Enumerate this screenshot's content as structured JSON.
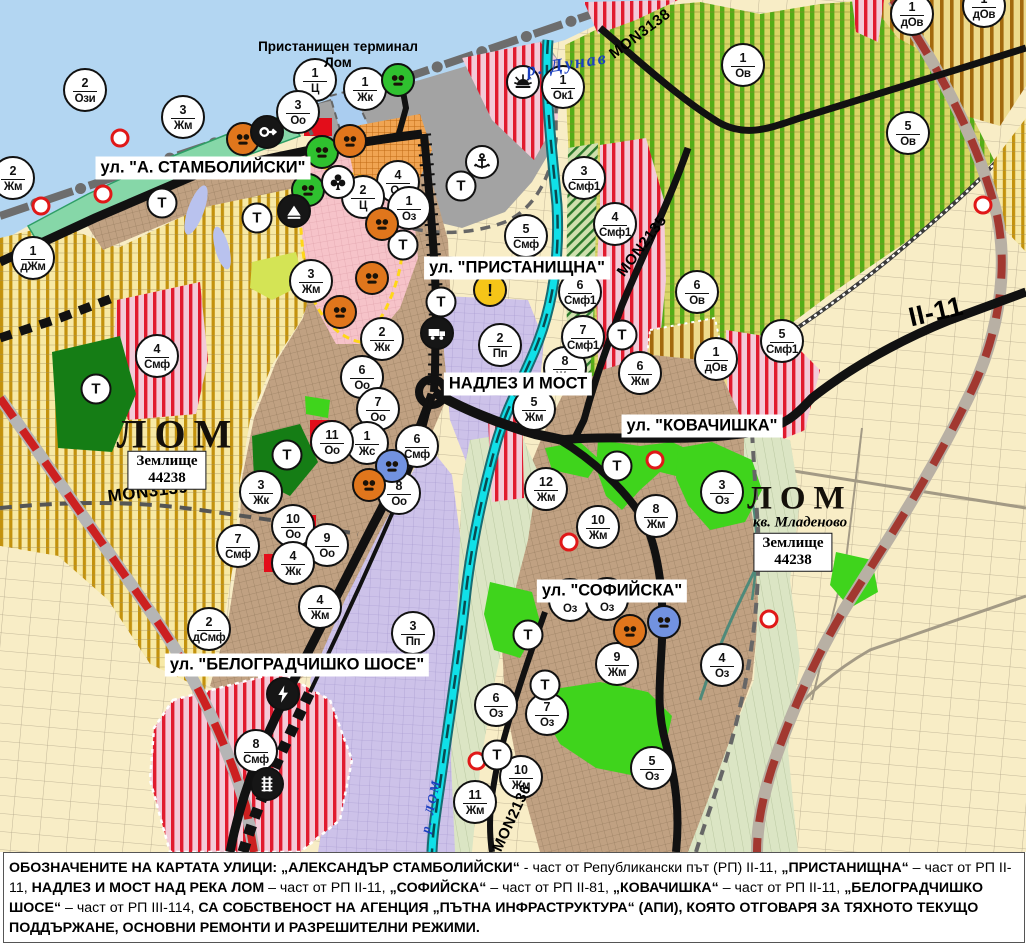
{
  "map": {
    "water_label": "р. Дунав",
    "river_label": "р. ЛОМ",
    "terminal_label": "Пристанищен терминал Лом",
    "streets": [
      {
        "text": "ул. \"А. СТАМБОЛИЙСКИ\"",
        "x": 203,
        "y": 168
      },
      {
        "text": "ул. \"ПРИСТАНИЩНА\"",
        "x": 517,
        "y": 268
      },
      {
        "text": "НАДЛЕЗ И МОСТ",
        "x": 518,
        "y": 384
      },
      {
        "text": "ул. \"КОВАЧИШКА\"",
        "x": 702,
        "y": 426
      },
      {
        "text": "ул. \"СОФИЙСКА\"",
        "x": 612,
        "y": 591
      },
      {
        "text": "ул. \"БЕЛОГРАДЧИШКО ШОСЕ\"",
        "x": 297,
        "y": 665
      }
    ],
    "road_codes": [
      {
        "text": "MON3138",
        "x": 640,
        "y": 34,
        "rot": -37,
        "size": 15
      },
      {
        "text": "MON2135",
        "x": 642,
        "y": 246,
        "rot": -53,
        "size": 15
      },
      {
        "text": "MON3139",
        "x": 148,
        "y": 492,
        "rot": -7,
        "size": 17
      },
      {
        "text": "MON2136",
        "x": 512,
        "y": 818,
        "rot": -65,
        "size": 15
      },
      {
        "text": "II-11",
        "x": 936,
        "y": 312,
        "rot": -13,
        "size": 27
      }
    ],
    "areas": [
      {
        "text": "ЛОМ",
        "x": 178,
        "y": 434,
        "size": 40
      },
      {
        "text": "ЛОМ",
        "x": 800,
        "y": 499,
        "size": 33
      }
    ],
    "district_label": "кв. Младеново",
    "land_boxes": [
      {
        "line1": "Землище",
        "line2": "44238",
        "x": 167,
        "y": 470
      },
      {
        "line1": "Землище",
        "line2": "44238",
        "x": 793,
        "y": 552
      }
    ]
  },
  "markers": {
    "t_label": "Т",
    "warn_label": "!",
    "zones": [
      {
        "x": 85,
        "y": 90,
        "n": "2",
        "c": "Ози"
      },
      {
        "x": 315,
        "y": 80,
        "n": "1",
        "c": "Ц"
      },
      {
        "x": 298,
        "y": 112,
        "n": "3",
        "c": "Оо"
      },
      {
        "x": 365,
        "y": 89,
        "n": "1",
        "c": "Жк"
      },
      {
        "x": 563,
        "y": 87,
        "n": "1",
        "c": "Ок1"
      },
      {
        "x": 183,
        "y": 117,
        "n": "3",
        "c": "Жм"
      },
      {
        "x": 13,
        "y": 178,
        "n": "2",
        "c": "Жм"
      },
      {
        "x": 33,
        "y": 258,
        "n": "1",
        "c": "дЖм"
      },
      {
        "x": 398,
        "y": 182,
        "n": "4",
        "c": "Оо"
      },
      {
        "x": 363,
        "y": 197,
        "n": "2",
        "c": "Ц"
      },
      {
        "x": 409,
        "y": 208,
        "n": "1",
        "c": "Оз"
      },
      {
        "x": 584,
        "y": 178,
        "n": "3",
        "c": "Смф1"
      },
      {
        "x": 526,
        "y": 236,
        "n": "5",
        "c": "Смф"
      },
      {
        "x": 580,
        "y": 292,
        "n": "6",
        "c": "Смф1"
      },
      {
        "x": 615,
        "y": 224,
        "n": "4",
        "c": "Смф1"
      },
      {
        "x": 500,
        "y": 345,
        "n": "2",
        "c": "Пп"
      },
      {
        "x": 382,
        "y": 339,
        "n": "2",
        "c": "Жк"
      },
      {
        "x": 362,
        "y": 377,
        "n": "6",
        "c": "Оо"
      },
      {
        "x": 378,
        "y": 409,
        "n": "7",
        "c": "Оо"
      },
      {
        "x": 367,
        "y": 443,
        "n": "1",
        "c": "Жс"
      },
      {
        "x": 417,
        "y": 446,
        "n": "6",
        "c": "Смф"
      },
      {
        "x": 399,
        "y": 493,
        "n": "8",
        "c": "Оо"
      },
      {
        "x": 332,
        "y": 442,
        "n": "11",
        "c": "Оо"
      },
      {
        "x": 157,
        "y": 356,
        "n": "4",
        "c": "Смф"
      },
      {
        "x": 534,
        "y": 409,
        "n": "5",
        "c": "Жм"
      },
      {
        "x": 546,
        "y": 489,
        "n": "12",
        "c": "Жм"
      },
      {
        "x": 565,
        "y": 368,
        "n": "8",
        "c": "Жм"
      },
      {
        "x": 640,
        "y": 373,
        "n": "6",
        "c": "Жм"
      },
      {
        "x": 583,
        "y": 337,
        "n": "7",
        "c": "Смф1"
      },
      {
        "x": 697,
        "y": 292,
        "n": "6",
        "c": "Ов"
      },
      {
        "x": 716,
        "y": 359,
        "n": "1",
        "c": "дОв"
      },
      {
        "x": 782,
        "y": 341,
        "n": "5",
        "c": "Смф1"
      },
      {
        "x": 743,
        "y": 65,
        "n": "1",
        "c": "Ов"
      },
      {
        "x": 908,
        "y": 133,
        "n": "5",
        "c": "Ов"
      },
      {
        "x": 912,
        "y": 14,
        "n": "1",
        "c": "дОв"
      },
      {
        "x": 984,
        "y": 6,
        "n": "1",
        "c": "дОв"
      },
      {
        "x": 598,
        "y": 527,
        "n": "10",
        "c": "Жм"
      },
      {
        "x": 656,
        "y": 516,
        "n": "8",
        "c": "Жм"
      },
      {
        "x": 722,
        "y": 492,
        "n": "3",
        "c": "Оз"
      },
      {
        "x": 617,
        "y": 664,
        "n": "9",
        "c": "Жм"
      },
      {
        "x": 722,
        "y": 665,
        "n": "4",
        "c": "Оз"
      },
      {
        "x": 496,
        "y": 705,
        "n": "6",
        "c": "Оз"
      },
      {
        "x": 547,
        "y": 714,
        "n": "7",
        "c": "Оз"
      },
      {
        "x": 652,
        "y": 768,
        "n": "5",
        "c": "Оз"
      },
      {
        "x": 521,
        "y": 777,
        "n": "10",
        "c": "Жм"
      },
      {
        "x": 475,
        "y": 802,
        "n": "11",
        "c": "Жм"
      },
      {
        "x": 570,
        "y": 600,
        "n": "2",
        "c": "Оз"
      },
      {
        "x": 607,
        "y": 599,
        "n": "1",
        "c": "Оз"
      },
      {
        "x": 209,
        "y": 629,
        "n": "2",
        "c": "дСмф"
      },
      {
        "x": 320,
        "y": 607,
        "n": "4",
        "c": "Жм"
      },
      {
        "x": 413,
        "y": 633,
        "n": "3",
        "c": "Пп"
      },
      {
        "x": 256,
        "y": 751,
        "n": "8",
        "c": "Смф"
      },
      {
        "x": 261,
        "y": 492,
        "n": "3",
        "c": "Жк"
      },
      {
        "x": 293,
        "y": 526,
        "n": "10",
        "c": "Оо"
      },
      {
        "x": 327,
        "y": 545,
        "n": "9",
        "c": "Оо"
      },
      {
        "x": 293,
        "y": 563,
        "n": "4",
        "c": "Жк"
      },
      {
        "x": 238,
        "y": 546,
        "n": "7",
        "c": "Смф"
      },
      {
        "x": 311,
        "y": 281,
        "n": "3",
        "c": "Жм"
      }
    ],
    "transformers": [
      {
        "x": 162,
        "y": 203
      },
      {
        "x": 257,
        "y": 218
      },
      {
        "x": 403,
        "y": 245
      },
      {
        "x": 461,
        "y": 186
      },
      {
        "x": 441,
        "y": 302
      },
      {
        "x": 622,
        "y": 335
      },
      {
        "x": 617,
        "y": 466
      },
      {
        "x": 528,
        "y": 635
      },
      {
        "x": 545,
        "y": 685
      },
      {
        "x": 497,
        "y": 755
      },
      {
        "x": 287,
        "y": 455
      },
      {
        "x": 96,
        "y": 389
      }
    ],
    "icons": [
      {
        "x": 398,
        "y": 80,
        "type": "mask",
        "bg": "green"
      },
      {
        "x": 523,
        "y": 82,
        "type": "sun",
        "bg": "white"
      },
      {
        "x": 482,
        "y": 162,
        "type": "anchor",
        "bg": "white"
      },
      {
        "x": 243,
        "y": 139,
        "type": "mask",
        "bg": "orange"
      },
      {
        "x": 267,
        "y": 132,
        "type": "key",
        "bg": "black"
      },
      {
        "x": 322,
        "y": 152,
        "type": "mask",
        "bg": "green"
      },
      {
        "x": 350,
        "y": 141,
        "type": "mask",
        "bg": "orange"
      },
      {
        "x": 308,
        "y": 190,
        "type": "mask",
        "bg": "green"
      },
      {
        "x": 338,
        "y": 182,
        "type": "club",
        "bg": "white"
      },
      {
        "x": 294,
        "y": 211,
        "type": "mount",
        "bg": "black"
      },
      {
        "x": 382,
        "y": 224,
        "type": "mask",
        "bg": "orange"
      },
      {
        "x": 372,
        "y": 278,
        "type": "mask",
        "bg": "orange"
      },
      {
        "x": 340,
        "y": 312,
        "type": "mask",
        "bg": "orange"
      },
      {
        "x": 392,
        "y": 466,
        "type": "mask",
        "bg": "blue"
      },
      {
        "x": 369,
        "y": 485,
        "type": "mask",
        "bg": "orange"
      },
      {
        "x": 630,
        "y": 631,
        "type": "mask",
        "bg": "orange"
      },
      {
        "x": 664,
        "y": 622,
        "type": "mask",
        "bg": "blue"
      },
      {
        "x": 490,
        "y": 290,
        "type": "warn",
        "bg": "yellow"
      },
      {
        "x": 437,
        "y": 333,
        "type": "truck",
        "bg": "black"
      },
      {
        "x": 283,
        "y": 694,
        "type": "lightning",
        "bg": "black"
      },
      {
        "x": 267,
        "y": 784,
        "type": "rail",
        "bg": "black"
      }
    ],
    "pois": [
      {
        "x": 120,
        "y": 138
      },
      {
        "x": 103,
        "y": 194
      },
      {
        "x": 41,
        "y": 206
      },
      {
        "x": 655,
        "y": 460
      },
      {
        "x": 569,
        "y": 542
      },
      {
        "x": 477,
        "y": 761
      },
      {
        "x": 983,
        "y": 205
      },
      {
        "x": 769,
        "y": 619
      }
    ]
  },
  "colors": {
    "water": "#b3d6f2",
    "water_far": "#c9e2f6",
    "river_lom": "#10e0e8",
    "residential_tan": "#c0a182",
    "villa_yellow": "#f7e9a6",
    "villa_stripe": "#c3920e",
    "smf_pink": "#f3cbd8",
    "smf_stripe": "#e11b2e",
    "orchard_green": "#d9d566",
    "orchard_stripe": "#54ad17",
    "dov_stripe": "#a3690e",
    "production_lavender": "#cdc2e9",
    "center_pink": "#f6c3c9",
    "park_green": "#3fd41c",
    "forest_green": "#157d15",
    "farmland_cream": "#f8edc6",
    "valley_sage": "#dbe5c4",
    "road_black": "#111111",
    "road_red_dash": "#cc2020",
    "port_gray": "#a3a3a3",
    "marker_orange": "#e0761c",
    "marker_green": "#2fc12f",
    "marker_blue": "#7292e0",
    "poi_red": "#e01818"
  },
  "note": {
    "segments": [
      {
        "t": "ОБОЗНАЧЕНИТЕ НА КАРТАТА УЛИЦИ: „АЛЕКСАНДЪР СТАМБОЛИЙСКИ“",
        "b": true
      },
      {
        "t": " - част от Републикански път (РП) II-11, ",
        "b": false
      },
      {
        "t": "„ПРИСТАНИЩНА“",
        "b": true
      },
      {
        "t": " – част от РП II-11, ",
        "b": false
      },
      {
        "t": "НАДЛЕЗ И МОСТ НАД РЕКА ЛОМ",
        "b": true
      },
      {
        "t": " – част от РП II-11, ",
        "b": false
      },
      {
        "t": "„СОФИЙСКА“",
        "b": true
      },
      {
        "t": " – част от РП II-81, ",
        "b": false
      },
      {
        "t": "„КОВАЧИШКА“",
        "b": true
      },
      {
        "t": " – част от РП II-11, ",
        "b": false
      },
      {
        "t": "„БЕЛОГРАДЧИШКО ШОСЕ“",
        "b": true
      },
      {
        "t": " – част от РП III-114, ",
        "b": false
      },
      {
        "t": "СА СОБСТВЕНОСТ НА АГЕНЦИЯ „ПЪТНА ИНФРАСТРУКТУРА“ (АПИ), КОЯТО ОТГОВАРЯ ЗА ТЯХНОТО ТЕКУЩО ПОДДЪРЖАНЕ, ОСНОВНИ РЕМОНТИ И РАЗРЕШИТЕЛНИ РЕЖИМИ.",
        "b": true
      }
    ]
  }
}
